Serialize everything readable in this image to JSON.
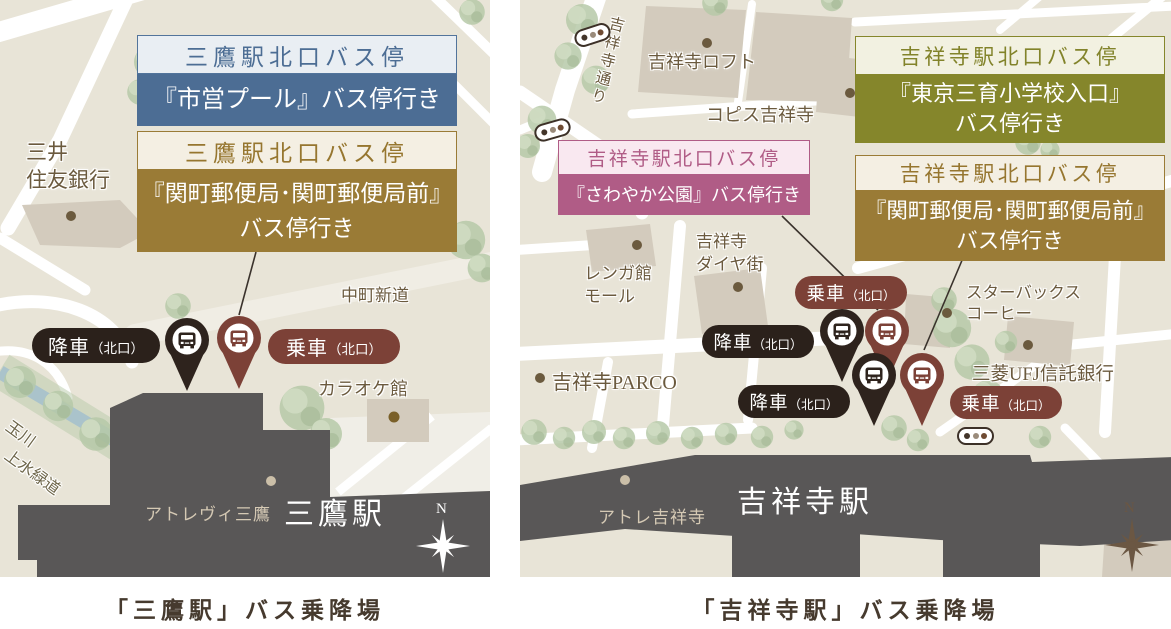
{
  "colors": {
    "map_bg": "#e8e4d7",
    "road": "#ffffff",
    "building": "#d3cbbd",
    "tree": "#b6c9a8",
    "stream": "#a9c2cc",
    "station_gray": "#595757",
    "label_brown": "#6b5a3e",
    "caption_brown": "#463a2e",
    "blue": "#4c6d94",
    "blue_light": "#e9eef3",
    "gold_brown": "#9a7b36",
    "brown_light": "#f4efe3",
    "olive": "#85862b",
    "olive_light": "#f2f1e1",
    "pink": "#b05c86",
    "pink_light": "#f9e8f0",
    "pill_black": "#2b211b",
    "pill_maroon": "#7c4137"
  },
  "maps": {
    "mitaka": {
      "caption": "「三鷹駅」バス乗降場",
      "boxes": [
        {
          "header": "三鷹駅北口バス停",
          "body": [
            "『市営プール』バス停行き"
          ]
        },
        {
          "header": "三鷹駅北口バス停",
          "body": [
            "『関町郵便局･関町郵便局前』",
            "バス停行き"
          ]
        }
      ],
      "pills": [
        {
          "label": "降車",
          "sub": "（北口）"
        },
        {
          "label": "乗車",
          "sub": "（北口）"
        }
      ],
      "places": {
        "bank": [
          "三井",
          "住友銀行"
        ],
        "nakacho": "中町新道",
        "karaoke": "カラオケ館",
        "greenway": [
          "玉川",
          "上水緑道"
        ],
        "atre": "アトレヴィ三鷹",
        "station": "三鷹駅"
      },
      "compass": "N"
    },
    "kichijoji": {
      "caption": "「吉祥寺駅」バス乗降場",
      "boxes": [
        {
          "header": "吉祥寺駅北口バス停",
          "body": [
            "『東京三育小学校入口』",
            "バス停行き"
          ]
        },
        {
          "header": "吉祥寺駅北口バス停",
          "body": [
            "『さわやか公園』バス停行き"
          ]
        },
        {
          "header": "吉祥寺駅北口バス停",
          "body": [
            "『関町郵便局･関町郵便局前』",
            "バス停行き"
          ]
        }
      ],
      "pills": [
        {
          "label": "乗車",
          "sub": "（北口）"
        },
        {
          "label": "降車",
          "sub": "（北口）"
        },
        {
          "label": "降車",
          "sub": "（北口）"
        },
        {
          "label": "乗車",
          "sub": "（北口）"
        }
      ],
      "places": {
        "loft": "吉祥寺ロフト",
        "coppice": "コピス吉祥寺",
        "street": "吉祥寺通り",
        "renga": [
          "レンガ館",
          "モール"
        ],
        "diya": [
          "吉祥寺",
          "ダイヤ街"
        ],
        "parco": "吉祥寺PARCO",
        "starbucks": [
          "スターバックス",
          "コーヒー"
        ],
        "ufj": "三菱UFJ信託銀行",
        "atre": "アトレ吉祥寺",
        "station": "吉祥寺駅"
      },
      "compass": "N"
    }
  }
}
